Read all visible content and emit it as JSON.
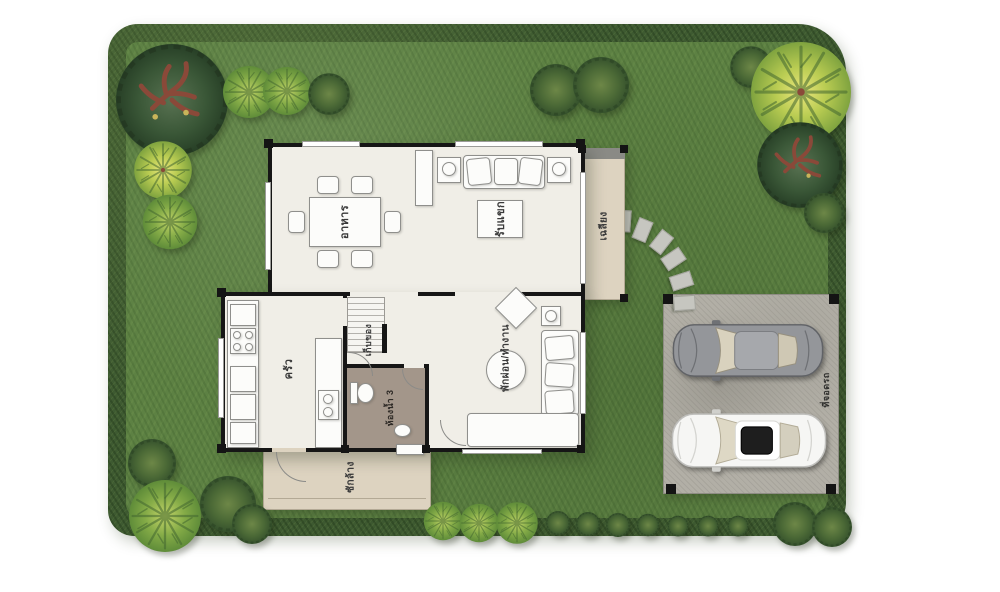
{
  "rooms": {
    "dining": "อาหาร",
    "living": "รับแขก",
    "terrace": "เฉลียง",
    "kitchen": "ครัว",
    "storage": "เก็บของ",
    "bathroom": "ห้องน้ำ 3",
    "family": "พักผ่อน/ทำงาน",
    "laundry": "ซักล้าง",
    "carport": "ที่จอดรถ"
  },
  "colors": {
    "lawn": "#5d8143",
    "hedge": "#3e5a31",
    "house_floor": "#f0eee7",
    "terrace_floor": "#ddd3c0",
    "bathroom_floor": "#a3968a",
    "carport_concrete": "#b2afa6",
    "wall": "#161616",
    "tree_light": "#a8c455",
    "tree_dark": "#3a5535",
    "silver_car": "#94969a",
    "white_car": "#f6f6f4"
  }
}
